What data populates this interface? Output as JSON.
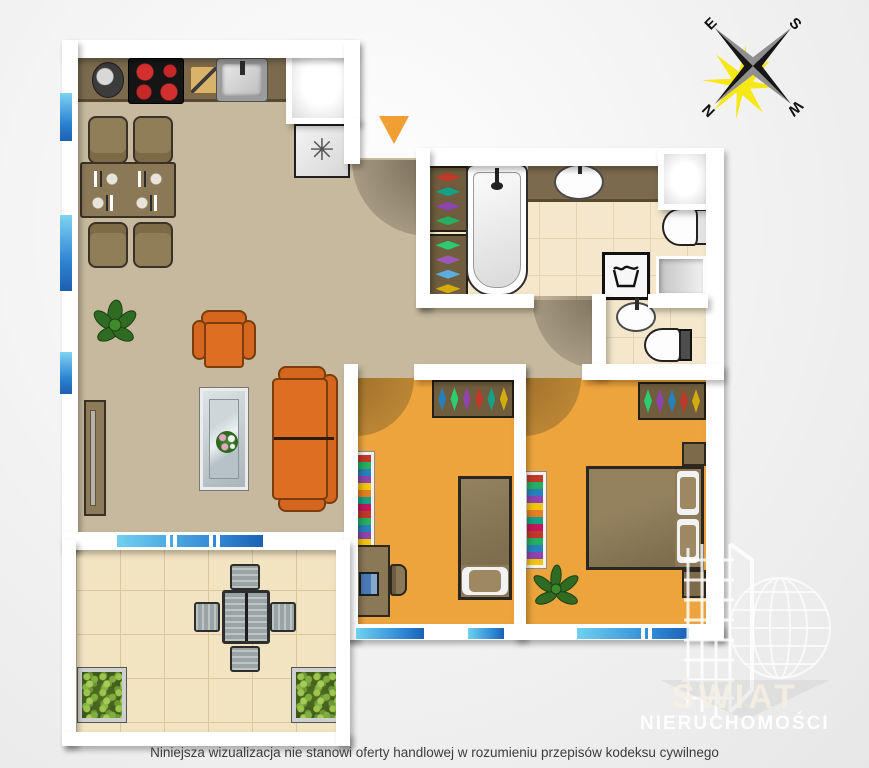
{
  "page": {
    "background": "#e9e9e9"
  },
  "compass": {
    "n": "N",
    "e": "E",
    "s": "S",
    "w": "W"
  },
  "kitchen": {
    "fridge_symbol": "✳"
  },
  "watermark": {
    "title": "ŚWIAT",
    "subtitle": "NIERUCHOMOŚCI"
  },
  "footer": {
    "disclaimer": "Niniejsza wizualizacja nie stanowi oferty handlowej w rozumieniu przepisów kodeksu cywilnego"
  },
  "colors": {
    "floor_living": "#c6b99d",
    "floor_bedroom": "#eda43c",
    "floor_bathroom_tile": "#f4e7cb",
    "floor_balcony_tile": "#f2e3c1",
    "wall": "#ffffff",
    "counter_brown": "#7b6a4e",
    "furniture_brown": "#907e58",
    "sofa_orange": "#d5661d",
    "window_blue_light": "#7ed3f0",
    "window_blue_dark": "#1d5fb0",
    "entrance_marker_orange": "#f0a032",
    "compass_glow_yellow": "#f6e60a",
    "background": "#e9e9e9"
  },
  "icons": {
    "entrance_marker": "orange triangle pointing down",
    "fridge_freezer": "asterisk symbol",
    "washing_machine": "laundry tub glyph",
    "compass_rose": "four point star with yellow sun glow"
  }
}
